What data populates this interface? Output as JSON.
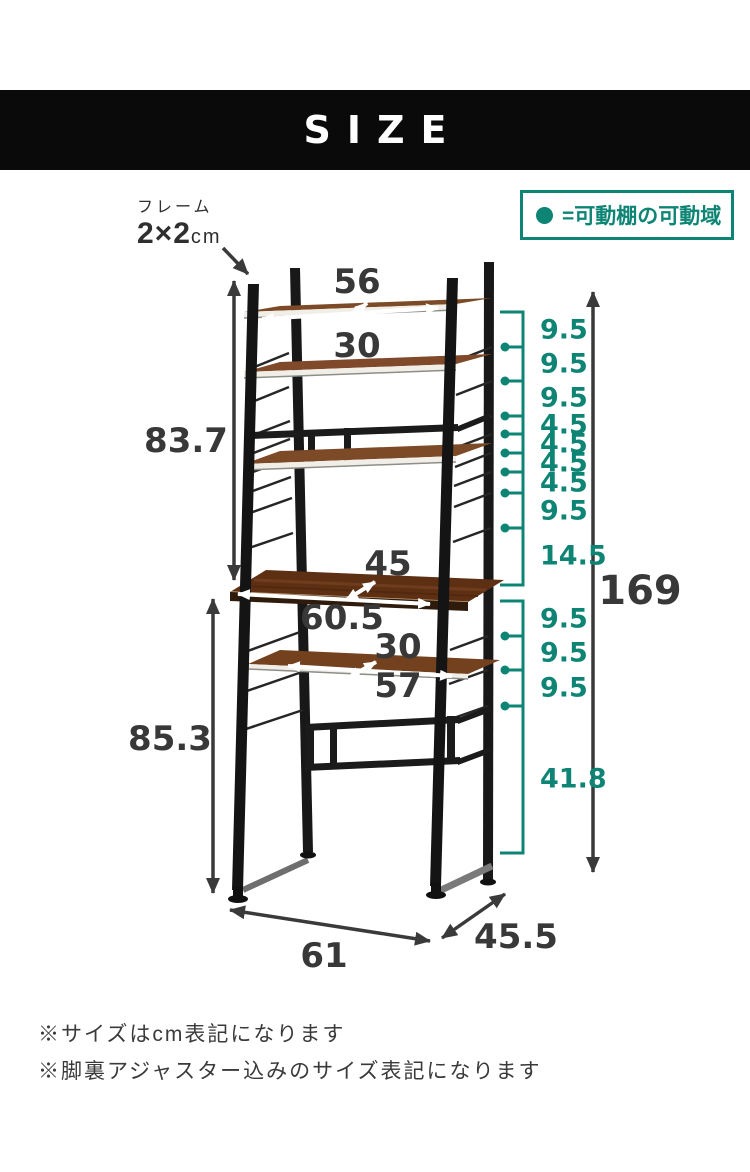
{
  "header": {
    "title": "SIZE"
  },
  "legend": {
    "label": "=可動棚の可動域"
  },
  "frame_note": {
    "line1": "フレーム",
    "value": "2×2",
    "unit": "cm"
  },
  "dims": {
    "top_shelf_width": "56",
    "top_shelf_depth": "30",
    "upper_section_height": "83.7",
    "desk_depth": "45",
    "desk_width": "60.5",
    "slide_shelf_depth": "30",
    "slide_shelf_width": "57",
    "lower_section_height": "85.3",
    "total_height": "169",
    "base_width": "61",
    "base_depth": "45.5"
  },
  "movable_upper": [
    "9.5",
    "9.5",
    "9.5",
    "4.5",
    "4.5",
    "4.5",
    "4.5",
    "9.5",
    "14.5"
  ],
  "movable_lower": [
    "9.5",
    "9.5",
    "9.5",
    "41.8"
  ],
  "notes": [
    "※サイズはcm表記になります",
    "※脚裏アジャスター込みのサイズ表記になります"
  ],
  "colors": {
    "accent": "#0d8474",
    "text": "#383838",
    "wood": "#6b3a22"
  }
}
